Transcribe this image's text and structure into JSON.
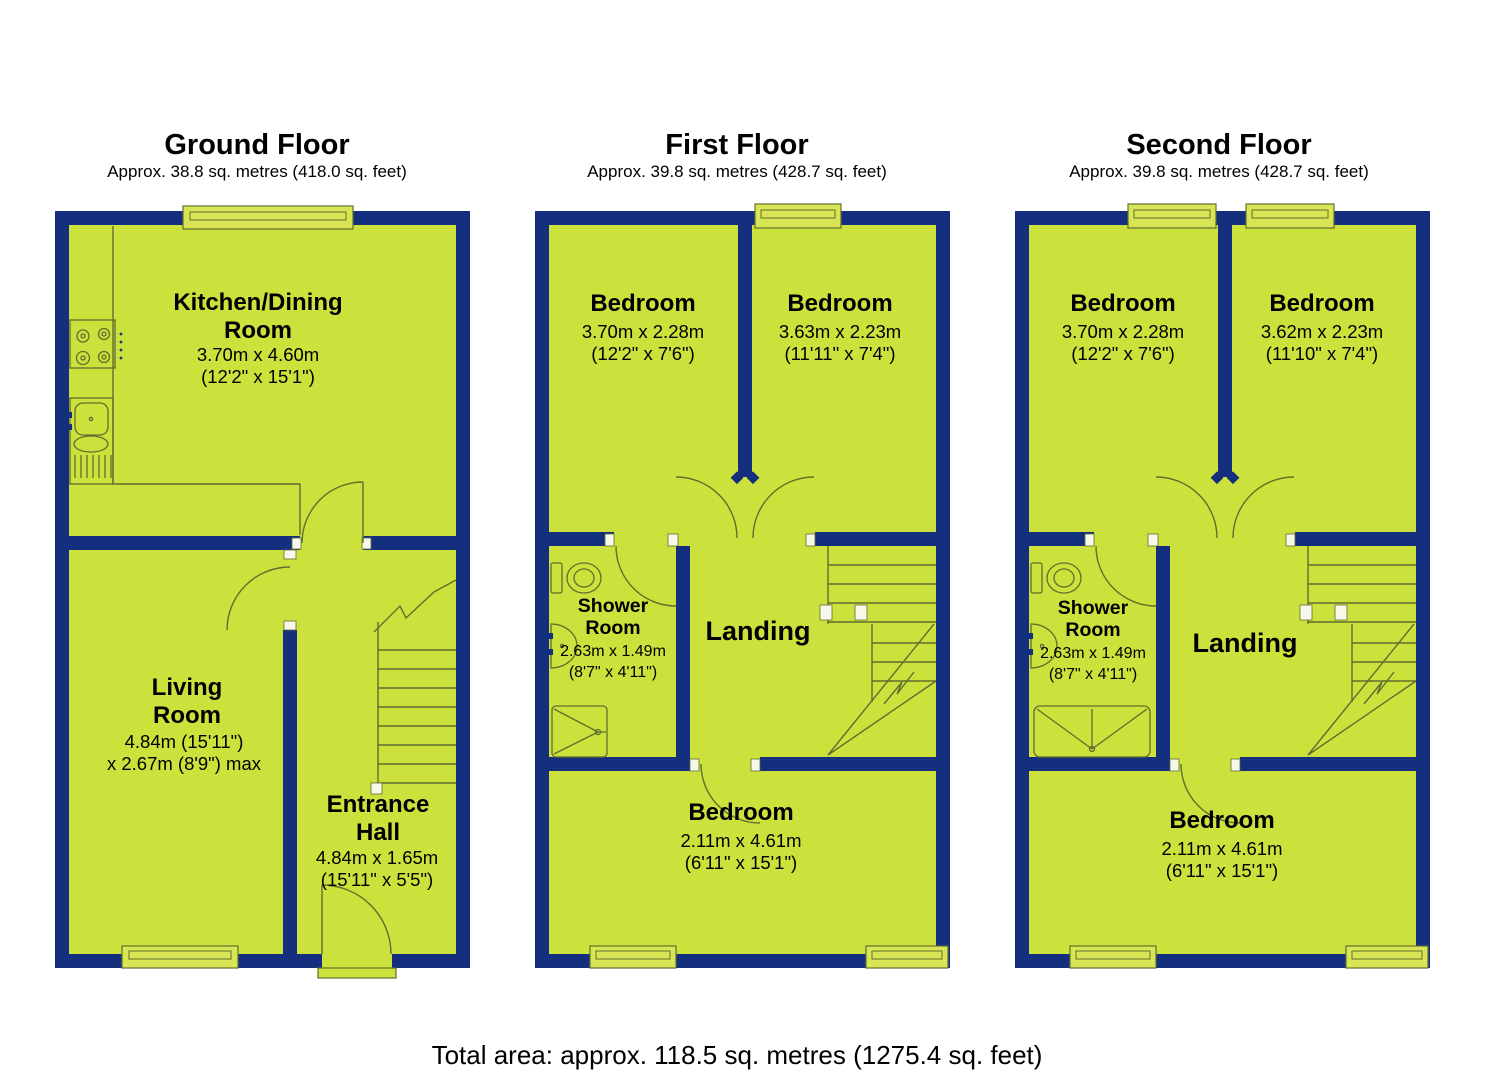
{
  "colors": {
    "wall": "#132f7d",
    "room": "#cde13c",
    "window": "#d9e554",
    "line": "#5f6e2e",
    "jamb": "#f7f8ea",
    "text": "#000000",
    "background": "#ffffff"
  },
  "footer": {
    "total_area": "Total area: approx. 118.5 sq. metres (1275.4 sq. feet)"
  },
  "floors": [
    {
      "title": "Ground Floor",
      "subtitle": "Approx. 38.8 sq. metres (418.0 sq. feet)",
      "rooms": {
        "kitchen": {
          "line1": "Kitchen/Dining",
          "line2": "Room",
          "dim1": "3.70m x 4.60m",
          "dim2": "(12'2\" x 15'1\")"
        },
        "living": {
          "line1": "Living",
          "line2": "Room",
          "dim1": "4.84m (15'11\")",
          "dim2": "x 2.67m (8'9\") max"
        },
        "entrance": {
          "line1": "Entrance",
          "line2": "Hall",
          "dim1": "4.84m x 1.65m",
          "dim2": "(15'11\" x 5'5\")"
        }
      }
    },
    {
      "title": "First Floor",
      "subtitle": "Approx. 39.8 sq. metres (428.7 sq. feet)",
      "rooms": {
        "bedroom_left": {
          "line1": "Bedroom",
          "dim1": "3.70m x 2.28m",
          "dim2": "(12'2\" x 7'6\")"
        },
        "bedroom_right": {
          "line1": "Bedroom",
          "dim1": "3.63m x 2.23m",
          "dim2": "(11'11\" x 7'4\")"
        },
        "shower": {
          "line1": "Shower",
          "line2": "Room",
          "dim1": "2.63m x 1.49m",
          "dim2": "(8'7\" x 4'11\")"
        },
        "landing": {
          "line1": "Landing"
        },
        "bedroom_bottom": {
          "line1": "Bedroom",
          "dim1": "2.11m x 4.61m",
          "dim2": "(6'11\" x 15'1\")"
        }
      }
    },
    {
      "title": "Second Floor",
      "subtitle": "Approx. 39.8 sq. metres (428.7 sq. feet)",
      "rooms": {
        "bedroom_left": {
          "line1": "Bedroom",
          "dim1": "3.70m x 2.28m",
          "dim2": "(12'2\" x 7'6\")"
        },
        "bedroom_right": {
          "line1": "Bedroom",
          "dim1": "3.62m x 2.23m",
          "dim2": "(11'10\" x 7'4\")"
        },
        "shower": {
          "line1": "Shower",
          "line2": "Room",
          "dim1": "2.63m x 1.49m",
          "dim2": "(8'7\" x 4'11\")"
        },
        "landing": {
          "line1": "Landing"
        },
        "bedroom_bottom": {
          "line1": "Bedroom",
          "dim1": "2.11m x 4.61m",
          "dim2": "(6'11\" x 15'1\")"
        }
      }
    }
  ]
}
